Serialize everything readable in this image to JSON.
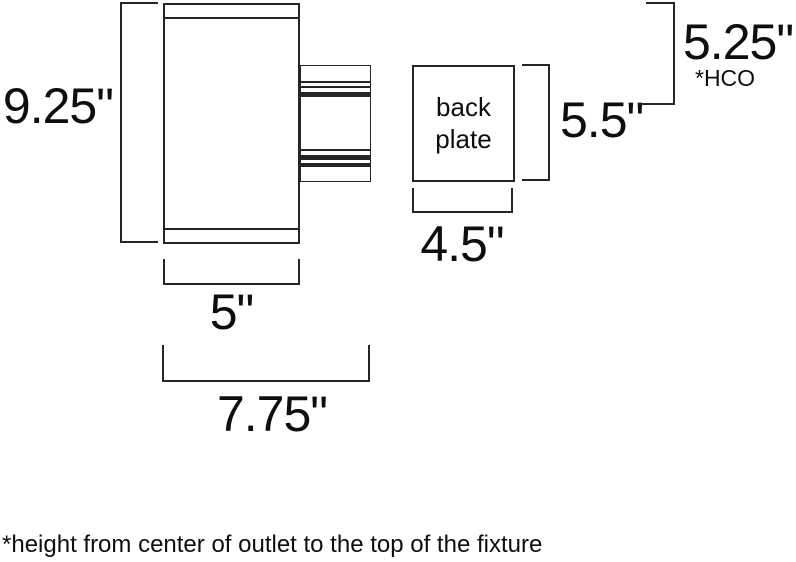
{
  "diagram_title": "wall sconce fixture dimension drawing",
  "colors": {
    "line": "#262626",
    "text": "#0e0e0e",
    "background": "#ffffff"
  },
  "fixture": {
    "height_label": "9.25\"",
    "width_label": "5\"",
    "projection_label": "7.75\""
  },
  "back_plate": {
    "name_line1": "back",
    "name_line2": "plate",
    "width_label": "4.5\"",
    "height_label": "5.5\""
  },
  "hco": {
    "value_label": "5.25\"",
    "abbrev_label": "*HCO"
  },
  "footnote": "*height from center of outlet to the top of the fixture"
}
